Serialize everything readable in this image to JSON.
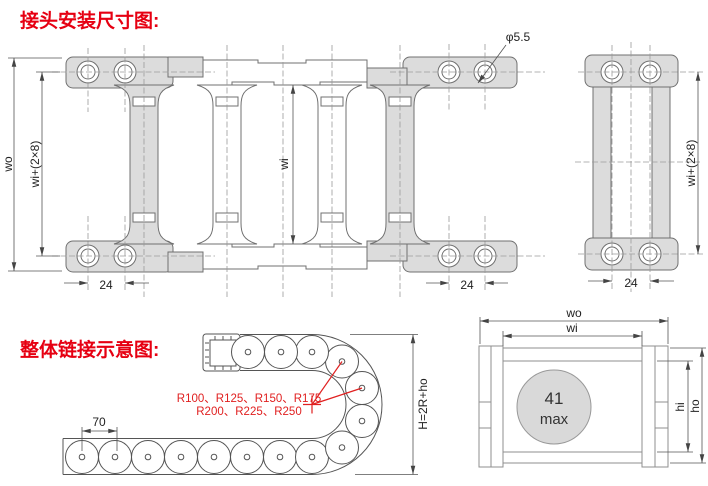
{
  "colors": {
    "accent_red": "#e60012",
    "drawing_line": "#707070",
    "bracket_fill": "#dcdcdc",
    "cable_fill": "#d9d9d9",
    "red_centerline": "#cc5555"
  },
  "titles": {
    "joint": "接头安装尺寸图:",
    "chain": "整体链接示意图:"
  },
  "top_view": {
    "dim_wo": "wo",
    "dim_wi_plus": "wi+(2×8)",
    "dim_wi": "wi",
    "dim_pitch_left": "24",
    "dim_pitch_right": "24",
    "dim_hole": "φ5.5"
  },
  "end_view": {
    "dim_wi_plus": "wi+(2×8)",
    "dim_pitch": "24"
  },
  "bend_view": {
    "dim_pitch": "70",
    "dim_height": "H=2R+ho",
    "radii_line1": "R100、R125、R150、R175",
    "radii_line2": "R200、R225、R250"
  },
  "section_view": {
    "dim_wo": "wo",
    "dim_wi": "wi",
    "dim_hi": "hi",
    "dim_ho": "ho",
    "cable_value": "41",
    "cable_unit": "max"
  }
}
